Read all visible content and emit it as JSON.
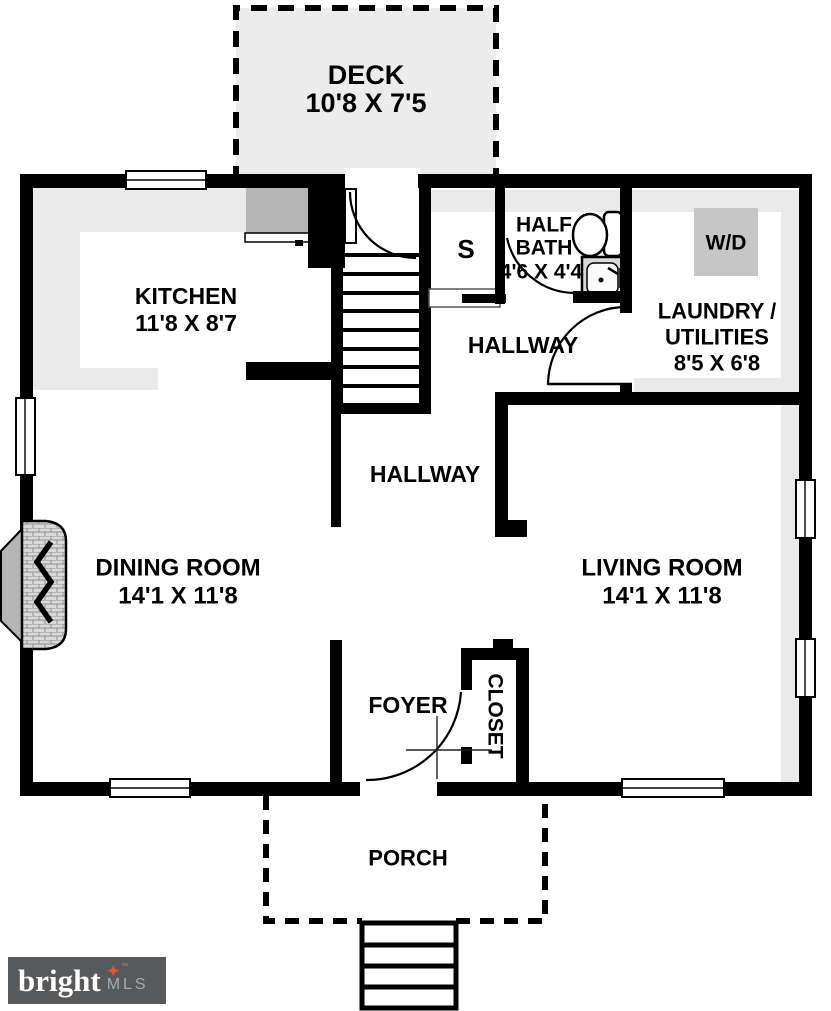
{
  "rooms": {
    "deck": {
      "label": "DECK",
      "dims": "10'8 X 7'5"
    },
    "kitchen": {
      "label": "KITCHEN",
      "dims": "11'8 X 8'7"
    },
    "stair_closet": {
      "label": "S"
    },
    "half_bath": {
      "label_line1": "HALF",
      "label_line2": "BATH",
      "dims": "4'6 X 4'4"
    },
    "laundry": {
      "label_line1": "LAUNDRY /",
      "label_line2": "UTILITIES",
      "dims": "8'5 X 6'8"
    },
    "washer_dryer": {
      "label": "W/D"
    },
    "hallway_upper": {
      "label": "HALLWAY"
    },
    "hallway_lower": {
      "label": "HALLWAY"
    },
    "dining_room": {
      "label": "DINING ROOM",
      "dims": "14'1 X 11'8"
    },
    "living_room": {
      "label": "LIVING ROOM",
      "dims": "14'1 X 11'8"
    },
    "foyer": {
      "label": "FOYER"
    },
    "closet": {
      "label": "CLOSET"
    },
    "porch": {
      "label": "PORCH"
    }
  },
  "watermark": {
    "brand": "bright",
    "tm": "™",
    "suffix": "MLS"
  },
  "colors": {
    "wall": "#000000",
    "floor": "#ffffff",
    "shading": "#eaeaea",
    "deck_fill": "#ececec",
    "appliance": "#b5b5b5",
    "washer_dryer_fill": "#c6c6c6",
    "fireplace": "#b5b5b5",
    "brick": "#d9d9d9",
    "logo_background": "#58595b",
    "logo_brand": "#ffffff",
    "logo_star": "#e05a2b",
    "logo_mls": "#a7a9ac"
  }
}
